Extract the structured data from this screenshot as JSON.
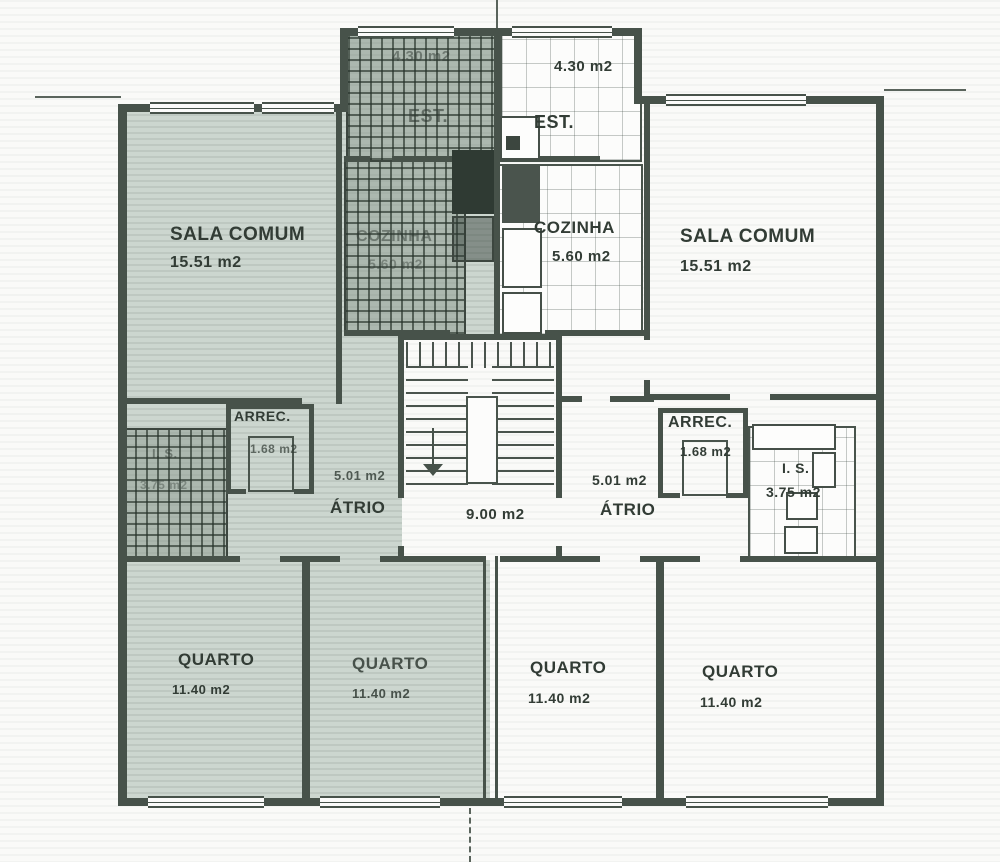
{
  "plan": {
    "units": {
      "left": {
        "sala": {
          "name": "SALA COMUM",
          "area": "15.51 m2"
        },
        "cozinha": {
          "name": "COZINHA",
          "area": "5.60 m2"
        },
        "est": {
          "name": "EST.",
          "area": "4.30 m2"
        },
        "arrec": {
          "name": "ARREC.",
          "area": "1.68 m2"
        },
        "is": {
          "name": "I. S.",
          "area": "3.75 m2"
        },
        "atrio": {
          "name": "ÁTRIO",
          "area": "5.01 m2"
        },
        "quarto1": {
          "name": "QUARTO",
          "area": "11.40 m2"
        },
        "quarto2": {
          "name": "QUARTO",
          "area": "11.40 m2"
        }
      },
      "right": {
        "sala": {
          "name": "SALA COMUM",
          "area": "15.51 m2"
        },
        "cozinha": {
          "name": "COZINHA",
          "area": "5.60 m2"
        },
        "est": {
          "name": "EST.",
          "area": "4.30 m2"
        },
        "arrec": {
          "name": "ARREC.",
          "area": "1.68 m2"
        },
        "is": {
          "name": "I. S.",
          "area": "3.75 m2"
        },
        "atrio": {
          "name": "ÁTRIO",
          "area": "5.01 m2"
        },
        "quarto3": {
          "name": "QUARTO",
          "area": "11.40 m2"
        },
        "quarto4": {
          "name": "QUARTO",
          "area": "11.40 m2"
        }
      },
      "stairwell": {
        "landing_area": "9.00 m2"
      }
    },
    "colors": {
      "highlight_tint": "#c9d3cc",
      "line": "#47524a",
      "paper": "#fafaf8"
    }
  }
}
